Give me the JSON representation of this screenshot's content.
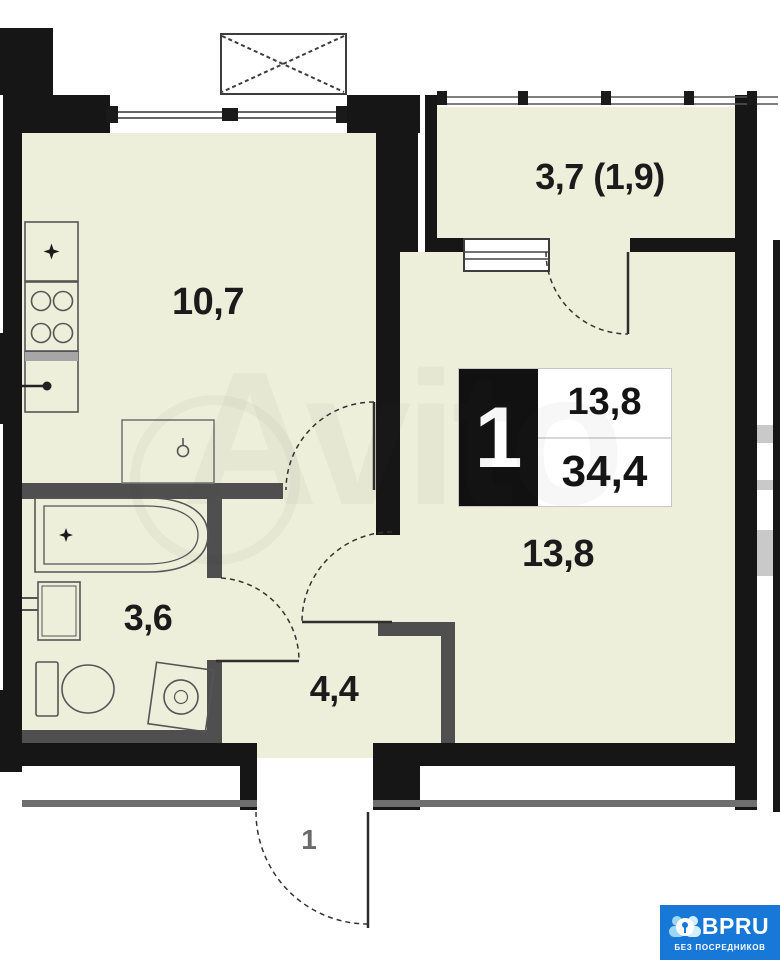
{
  "watermark": {
    "text": "Avito"
  },
  "plan": {
    "rooms": {
      "balcony": {
        "label": "3,7 (1,9)"
      },
      "kitchen": {
        "label": "10,7"
      },
      "living": {
        "label": "13,8"
      },
      "bathroom": {
        "label": "3,6"
      },
      "hallway": {
        "label": "4,4"
      }
    },
    "entrance": {
      "door_label": "1"
    },
    "info_box": {
      "rooms_count": "1",
      "living_area": "13,8",
      "total_area": "34,4"
    },
    "colors": {
      "floor": "#edefda",
      "wall": "#161616",
      "partition": "#4f4f4f",
      "logo_blue": "#1878d8"
    }
  },
  "footer_logo": {
    "brand": "BPRU",
    "tagline": "БЕЗ ПОСРЕДНИКОВ"
  }
}
